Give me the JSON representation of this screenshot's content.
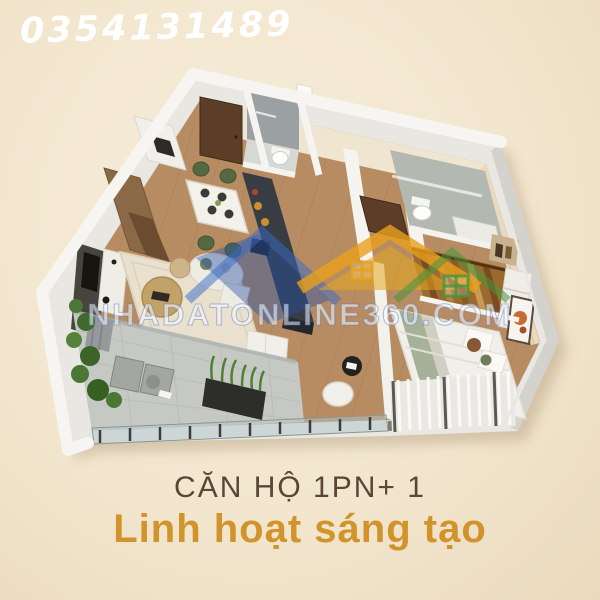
{
  "page": {
    "background_color": "#f2e6ce"
  },
  "contact": {
    "phone_number": "0354131489",
    "text_color": "#ffffff"
  },
  "floor_plan": {
    "type": "isometric-3d-apartment-render",
    "rooms": [
      "living-room",
      "dining-area",
      "kitchen",
      "entry-bathroom",
      "main-bathroom",
      "walk-in-closet",
      "bedroom",
      "study-nook",
      "balcony"
    ],
    "colors": {
      "wall": "#f6f5f1",
      "wall_shadow": "#d4d2cd",
      "wood_floor": "#b78c63",
      "rug": "#e9e1ce",
      "balcony_tile": "#c6c9c3",
      "bathroom_tile": "#9ba1a3",
      "kitchen_island": "#383d44",
      "cabinet_wood": "#8b6846",
      "door_wood": "#5c3e28",
      "chair_green": "#55683f",
      "wardrobe_amber": "#9b6a2e",
      "bed_white": "#f1efe9",
      "plant_green": "#4a7733",
      "accent_orange": "#c96a33"
    }
  },
  "watermark": {
    "text": "NHADATONLINE360.COM",
    "logo_houses": [
      "blue-house",
      "gold-roof-house",
      "green-house"
    ],
    "logo_colors": {
      "blue": "#2f66c4",
      "green": "#3c9a44",
      "gold": "#e6a01e"
    }
  },
  "caption": {
    "title": "CĂN HỘ 1PN+ 1",
    "subtitle": "Linh hoạt sáng tạo",
    "title_color": "#5c4536",
    "subtitle_color": "#d2932b"
  }
}
